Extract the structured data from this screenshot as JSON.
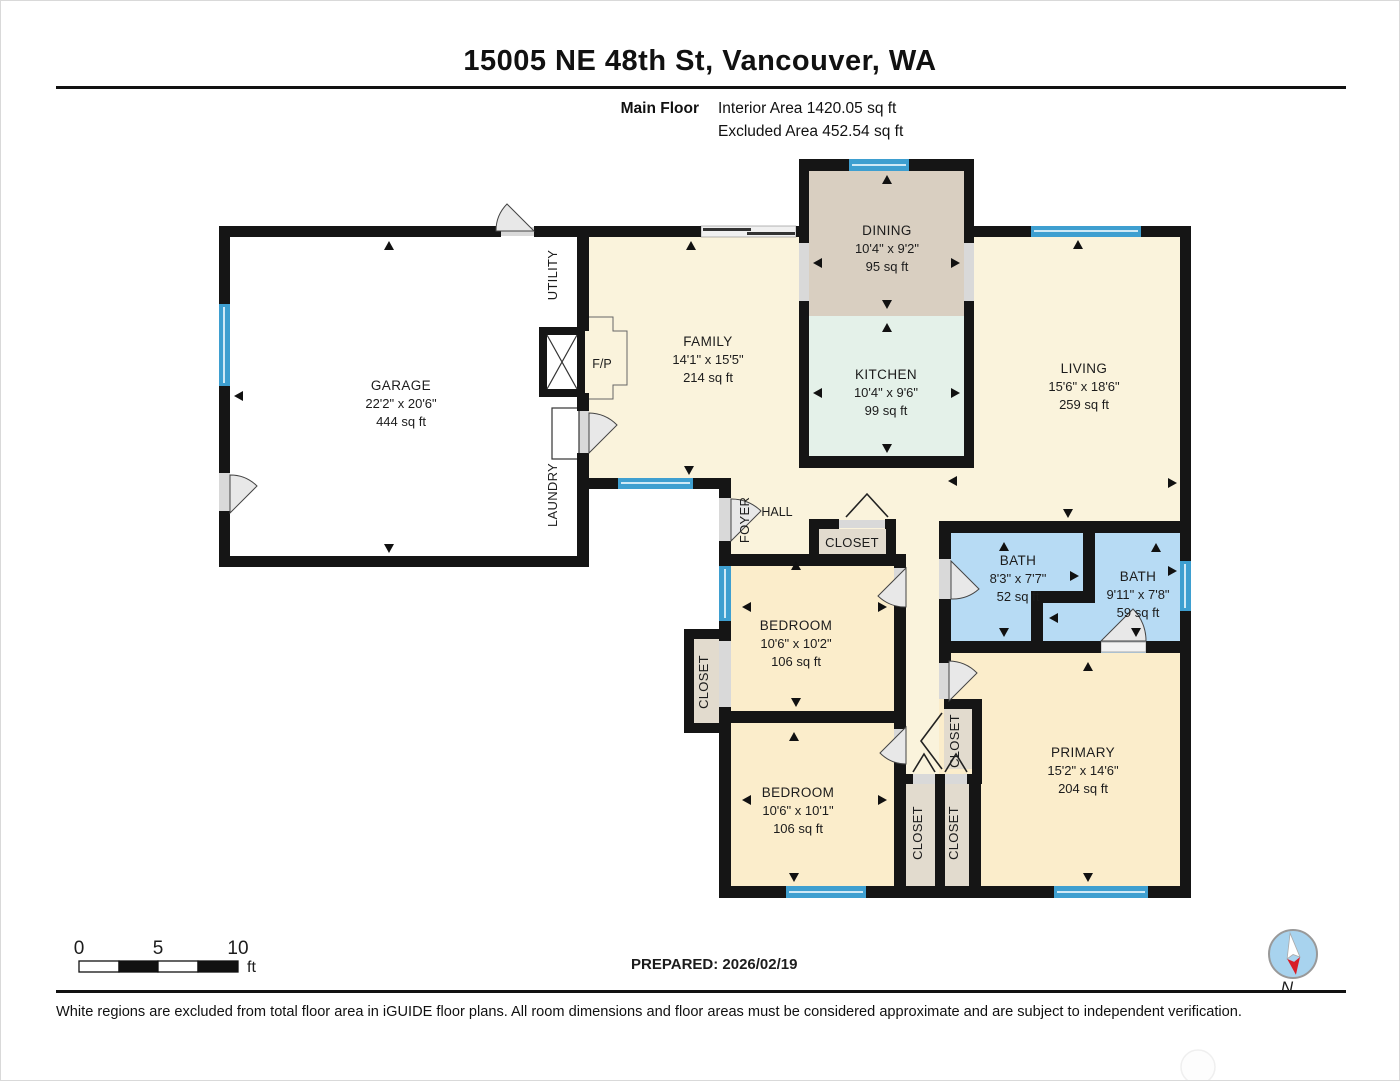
{
  "header": {
    "title": "15005 NE 48th St, Vancouver, WA",
    "floor_label": "Main Floor",
    "interior_area": "Interior Area 1420.05 sq ft",
    "excluded_area": "Excluded Area 452.54 sq ft"
  },
  "rooms": {
    "garage": {
      "name": "GARAGE",
      "dims": "22'2\" x 20'6\"",
      "area": "444 sq ft"
    },
    "family": {
      "name": "FAMILY",
      "dims": "14'1\" x 15'5\"",
      "area": "214 sq ft"
    },
    "dining": {
      "name": "DINING",
      "dims": "10'4\" x 9'2\"",
      "area": "95 sq ft"
    },
    "kitchen": {
      "name": "KITCHEN",
      "dims": "10'4\" x 9'6\"",
      "area": "99 sq ft"
    },
    "living": {
      "name": "LIVING",
      "dims": "15'6\" x 18'6\"",
      "area": "259 sq ft"
    },
    "bath1": {
      "name": "BATH",
      "dims": "8'3\" x 7'7\"",
      "area": "52 sq ft"
    },
    "bath2": {
      "name": "BATH",
      "dims": "9'11\" x 7'8\"",
      "area": "59 sq ft"
    },
    "bedroom1": {
      "name": "BEDROOM",
      "dims": "10'6\" x 10'2\"",
      "area": "106 sq ft"
    },
    "bedroom2": {
      "name": "BEDROOM",
      "dims": "10'6\" x 10'1\"",
      "area": "106 sq ft"
    },
    "primary": {
      "name": "PRIMARY",
      "dims": "15'2\" x 14'6\"",
      "area": "204 sq ft"
    }
  },
  "labels": {
    "utility": "UTILITY",
    "laundry": "LAUNDRY",
    "foyer": "FOYER",
    "hall": "HALL",
    "fp": "F/P",
    "closet": "CLOSET"
  },
  "scale": {
    "tick0": "0",
    "tick5": "5",
    "tick10": "10",
    "unit": "ft"
  },
  "compass": {
    "north": "N"
  },
  "prepared": "PREPARED: 2026/02/19",
  "footer": "White regions are excluded from total floor area in iGUIDE floor plans. All room dimensions and floor areas must be considered approximate and are subject to independent verification.",
  "colors": {
    "wall": "#151515",
    "excluded_white": "#FFFFFF",
    "living_cream": "#FAF3DC",
    "bedroom_peach": "#FBEDCB",
    "dining_tan": "#D9CFC1",
    "kitchen_mint": "#E4F1E9",
    "bath_blue": "#B7DBF4",
    "window_blue": "#3E9FD0",
    "closet_gray": "#E2DBCE",
    "compass_blue": "#A8D3EE",
    "compass_red": "#D81E27"
  }
}
